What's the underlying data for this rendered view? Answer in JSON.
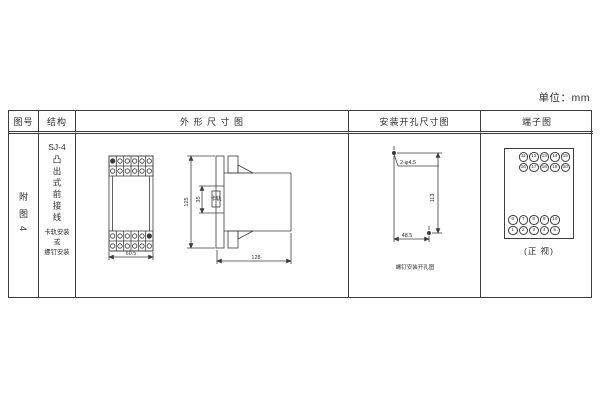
{
  "unit_label": "单位：mm",
  "table": {
    "headers": {
      "figure_no": "图号",
      "structure": "结构",
      "outline": "外 形 尺 寸 图",
      "mounting": "安装开孔尺寸图",
      "terminal": "端子图"
    }
  },
  "figure": {
    "no": "附图4"
  },
  "structure": {
    "model": "SJ-4",
    "type_vertical": "凸出式前接线",
    "mount_note": "卡轨安装\n或\n螺钉安装"
  },
  "outline_diagram": {
    "front_width": "60.5",
    "height": "125",
    "rail_width": "35",
    "rail_label": "卡轨",
    "depth": "128"
  },
  "mounting_diagram": {
    "holes_label": "2-φ4.5",
    "height_spacing": "113",
    "width_spacing": "48.5",
    "caption": "螺钉安装开孔图"
  },
  "terminal_diagram": {
    "top_rows": [
      [
        "11",
        "12",
        "13",
        "14",
        "15"
      ],
      [
        "16",
        "17",
        "18",
        "19",
        "20"
      ]
    ],
    "bottom_rows": [
      [
        "6",
        "7",
        "8",
        "9",
        "10"
      ],
      [
        "1",
        "2",
        "3",
        "4",
        "5"
      ]
    ],
    "caption": "(正 视)"
  }
}
